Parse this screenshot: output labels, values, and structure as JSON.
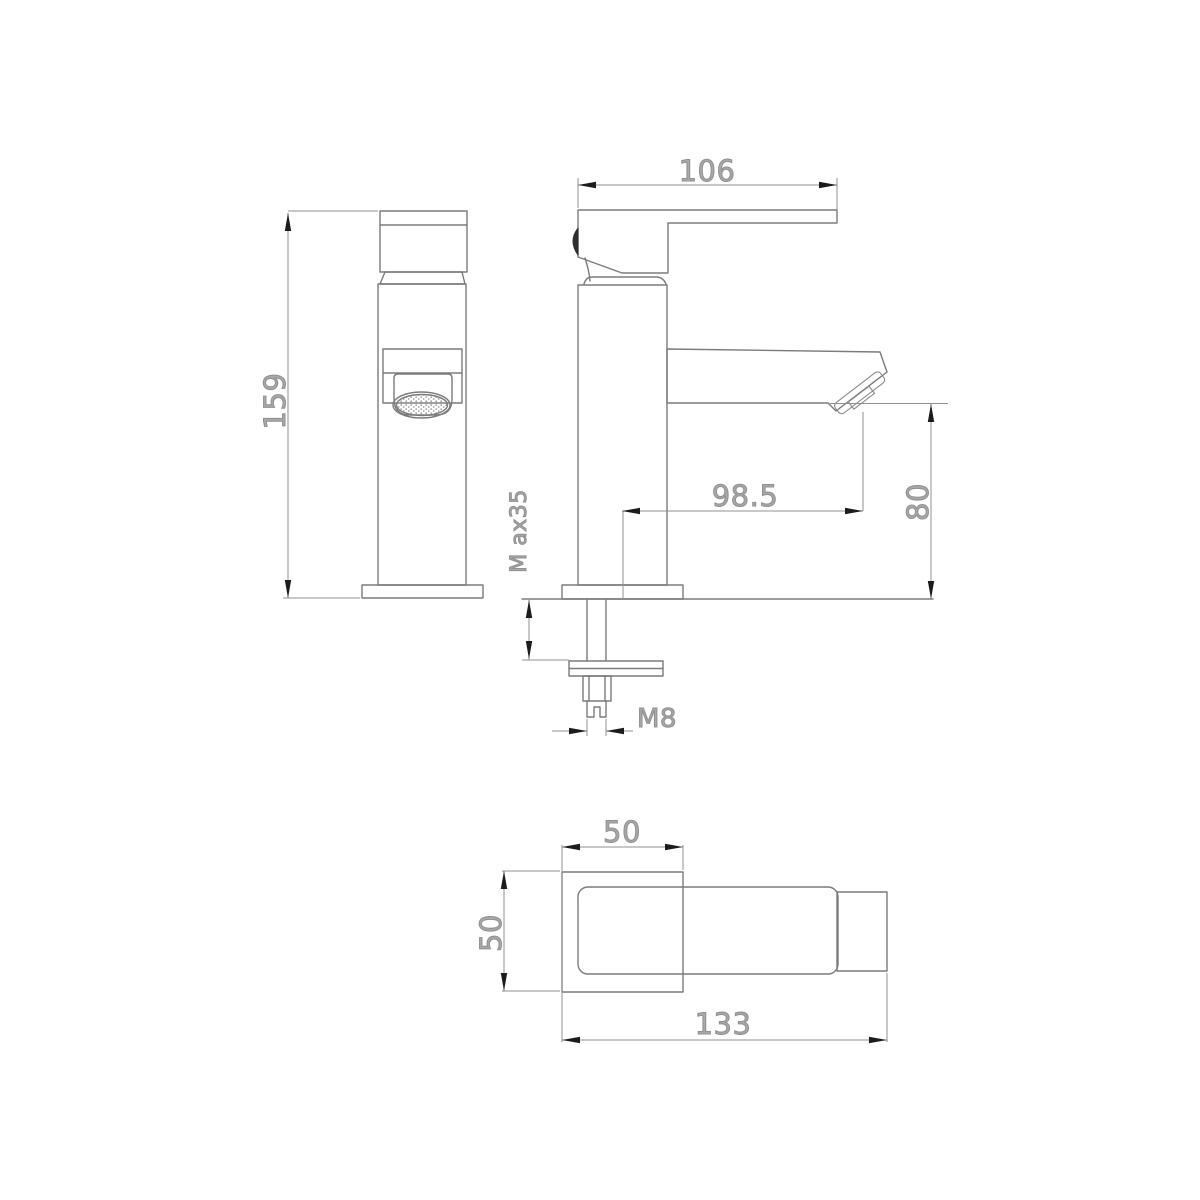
{
  "page": {
    "background": "#ffffff"
  },
  "drawing": {
    "kind": "technical-dimension-drawing",
    "subject": "single-lever basin mixer tap",
    "colors": {
      "object_line": "#7b7b7b",
      "dimension_line": "#909090",
      "arrowhead": "#1c1c1c",
      "dimension_text": "#a8a8a8"
    },
    "views": [
      {
        "id": "front",
        "name": "front view"
      },
      {
        "id": "side",
        "name": "side view"
      },
      {
        "id": "bottom",
        "name": "bottom view"
      }
    ],
    "dimensions": {
      "overall_height": {
        "label": "159",
        "view": "front"
      },
      "handle_length": {
        "label": "106",
        "view": "side"
      },
      "spout_reach": {
        "label": "98.5",
        "view": "side"
      },
      "outlet_height": {
        "label": "80",
        "view": "side"
      },
      "max_deck_thickness": {
        "label": "M ax35",
        "view": "side"
      },
      "thread_size": {
        "label": "M8",
        "view": "side"
      },
      "base_width": {
        "label": "50",
        "view": "bottom"
      },
      "base_depth": {
        "label": "50",
        "view": "bottom"
      },
      "overall_length": {
        "label": "133",
        "view": "bottom"
      }
    }
  }
}
